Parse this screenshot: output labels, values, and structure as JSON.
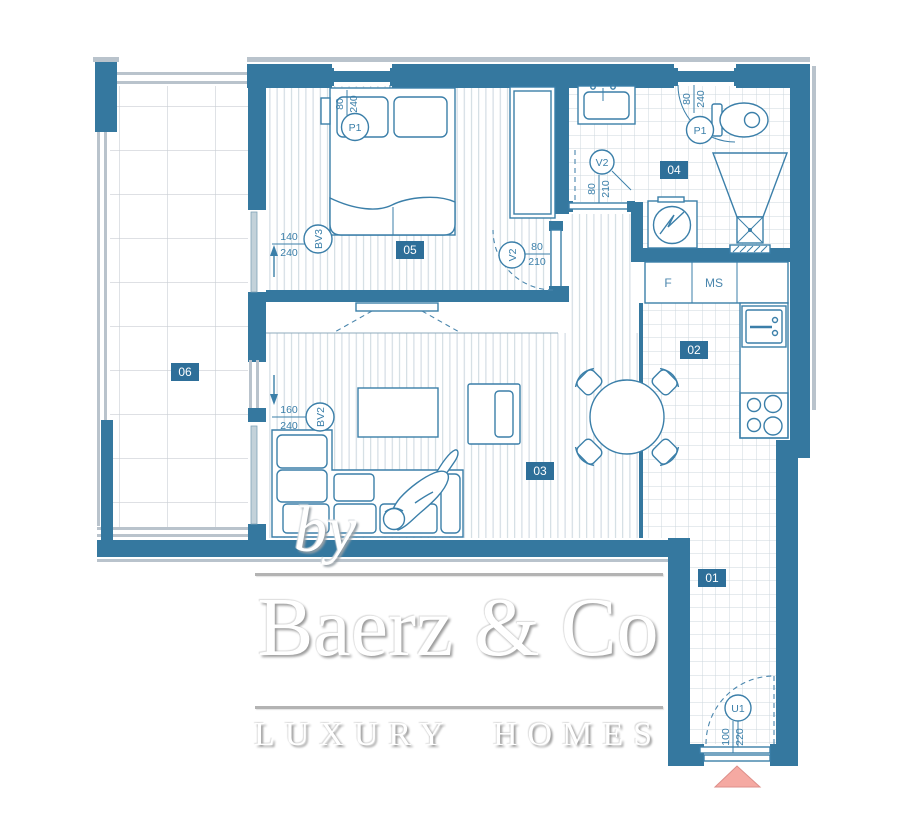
{
  "brand": {
    "by": "by",
    "name": "Baerz & Co",
    "tagline": "LUXURY HOMES"
  },
  "rooms": {
    "hall": {
      "number": "01"
    },
    "kitchen": {
      "number": "02"
    },
    "living": {
      "number": "03"
    },
    "bathroom": {
      "number": "04"
    },
    "bedroom": {
      "number": "05"
    },
    "terrace": {
      "number": "06"
    }
  },
  "openings": {
    "bedroom_door": {
      "label": "P1",
      "w": "80",
      "h": "240"
    },
    "bathroom_door": {
      "label": "P1",
      "w": "80",
      "h": "240"
    },
    "bedroom_inner_door": {
      "label": "V2",
      "w": "80",
      "h": "210"
    },
    "bathroom_inner_door": {
      "label": "V2",
      "w": "80",
      "h": "210"
    },
    "bedroom_balcony_door": {
      "label": "BV3",
      "w": "140",
      "h": "240"
    },
    "living_balcony_door": {
      "label": "BV2",
      "w": "160",
      "h": "240"
    },
    "entrance_door": {
      "label": "U1",
      "w": "100",
      "h": "220"
    }
  },
  "kitchen_units": {
    "fridge": "F",
    "cabinet": "MS"
  },
  "colors": {
    "wall": "#35789f",
    "line": "#3b7fa9",
    "badge": "#2e6f99",
    "grid": "#ccd7de",
    "railing": "#b9c3cc",
    "entrance_marker": "#f5a9a2"
  }
}
